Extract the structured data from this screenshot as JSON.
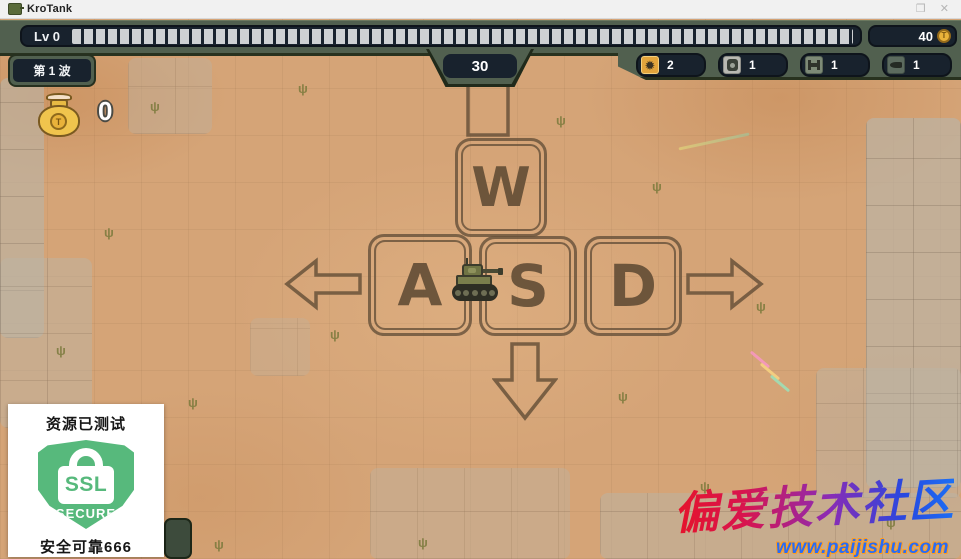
{
  "window": {
    "title": "KroTank",
    "controls": {
      "maximize": "❒",
      "close": "✕"
    }
  },
  "hud": {
    "level_label": "Lv 0",
    "level_progress_segments": 63,
    "coins": "40",
    "coin_symbol": "T",
    "wave_label": "第 1 波",
    "timer": "30",
    "money": "0",
    "items": [
      {
        "icon": "mine-splat",
        "count": "2"
      },
      {
        "icon": "barrel-mine",
        "count": "1"
      },
      {
        "icon": "barricade",
        "count": "1"
      },
      {
        "icon": "shell",
        "count": "1"
      }
    ]
  },
  "keys": {
    "up": "W",
    "left": "A",
    "down": "S",
    "right": "D"
  },
  "ssl_badge": {
    "top_text": "资源已测试",
    "shield_line1": "SSL",
    "shield_line2": "SECURE",
    "bottom_text": "安全可靠666"
  },
  "watermark": {
    "title": "偏爱技术社区",
    "url": "www.paijishu.com"
  },
  "icons": {
    "mine_glyph": "✹"
  },
  "colors": {
    "hud_green": "#51604f",
    "hud_navy": "#18222d",
    "coin_gold": "#e9b23a",
    "slot1_orange": "#e2a43c",
    "sand": "#d5a477",
    "key_outline": "#68523a",
    "ssl_green": "#57b97c",
    "watermark_red": "#e6132a",
    "watermark_blue": "#1b70f5",
    "url_blue": "#2a6cf4",
    "url_outline": "#ff9d1f"
  }
}
